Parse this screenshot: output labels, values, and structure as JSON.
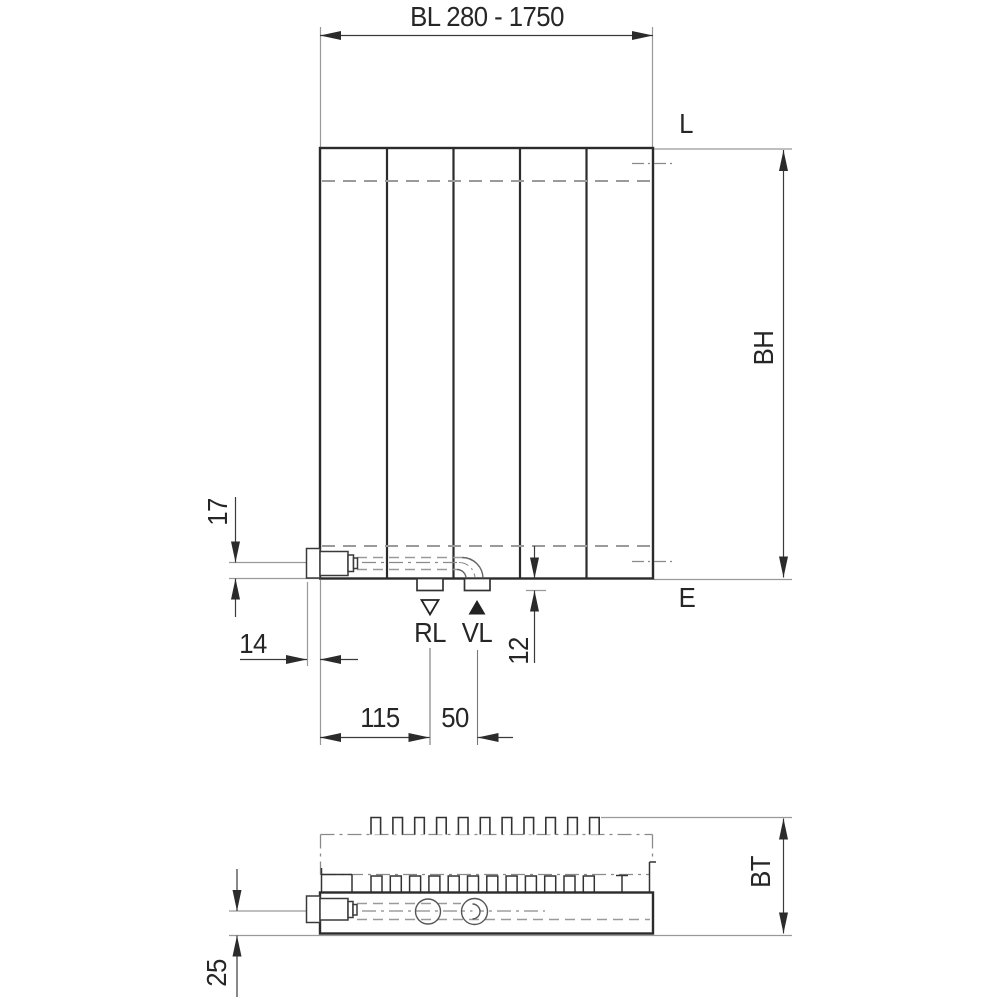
{
  "drawing": {
    "width_dim_label": "BL 280 - 1750",
    "front_view": {
      "level_top_label": "L",
      "level_bottom_label": "E",
      "height_dim_label": "BH",
      "return_connection_label": "RL",
      "supply_connection_label": "VL",
      "dim_pipe_axis_to_bottom": "17",
      "dim_valve_protrusion": "14",
      "dim_edge_to_return": "115",
      "dim_return_to_supply": "50",
      "dim_stub_height": "12"
    },
    "top_view": {
      "depth_dim_label": "BT",
      "dim_pipe_axis_to_front": "25"
    },
    "colors": {
      "outline": "#2b2b2b",
      "hidden_line_gray": "#9a9a9a",
      "centerline_gray": "#8a8a8a",
      "dimension_line": "#3a3a3a",
      "text": "#262626",
      "background": "#ffffff"
    }
  }
}
